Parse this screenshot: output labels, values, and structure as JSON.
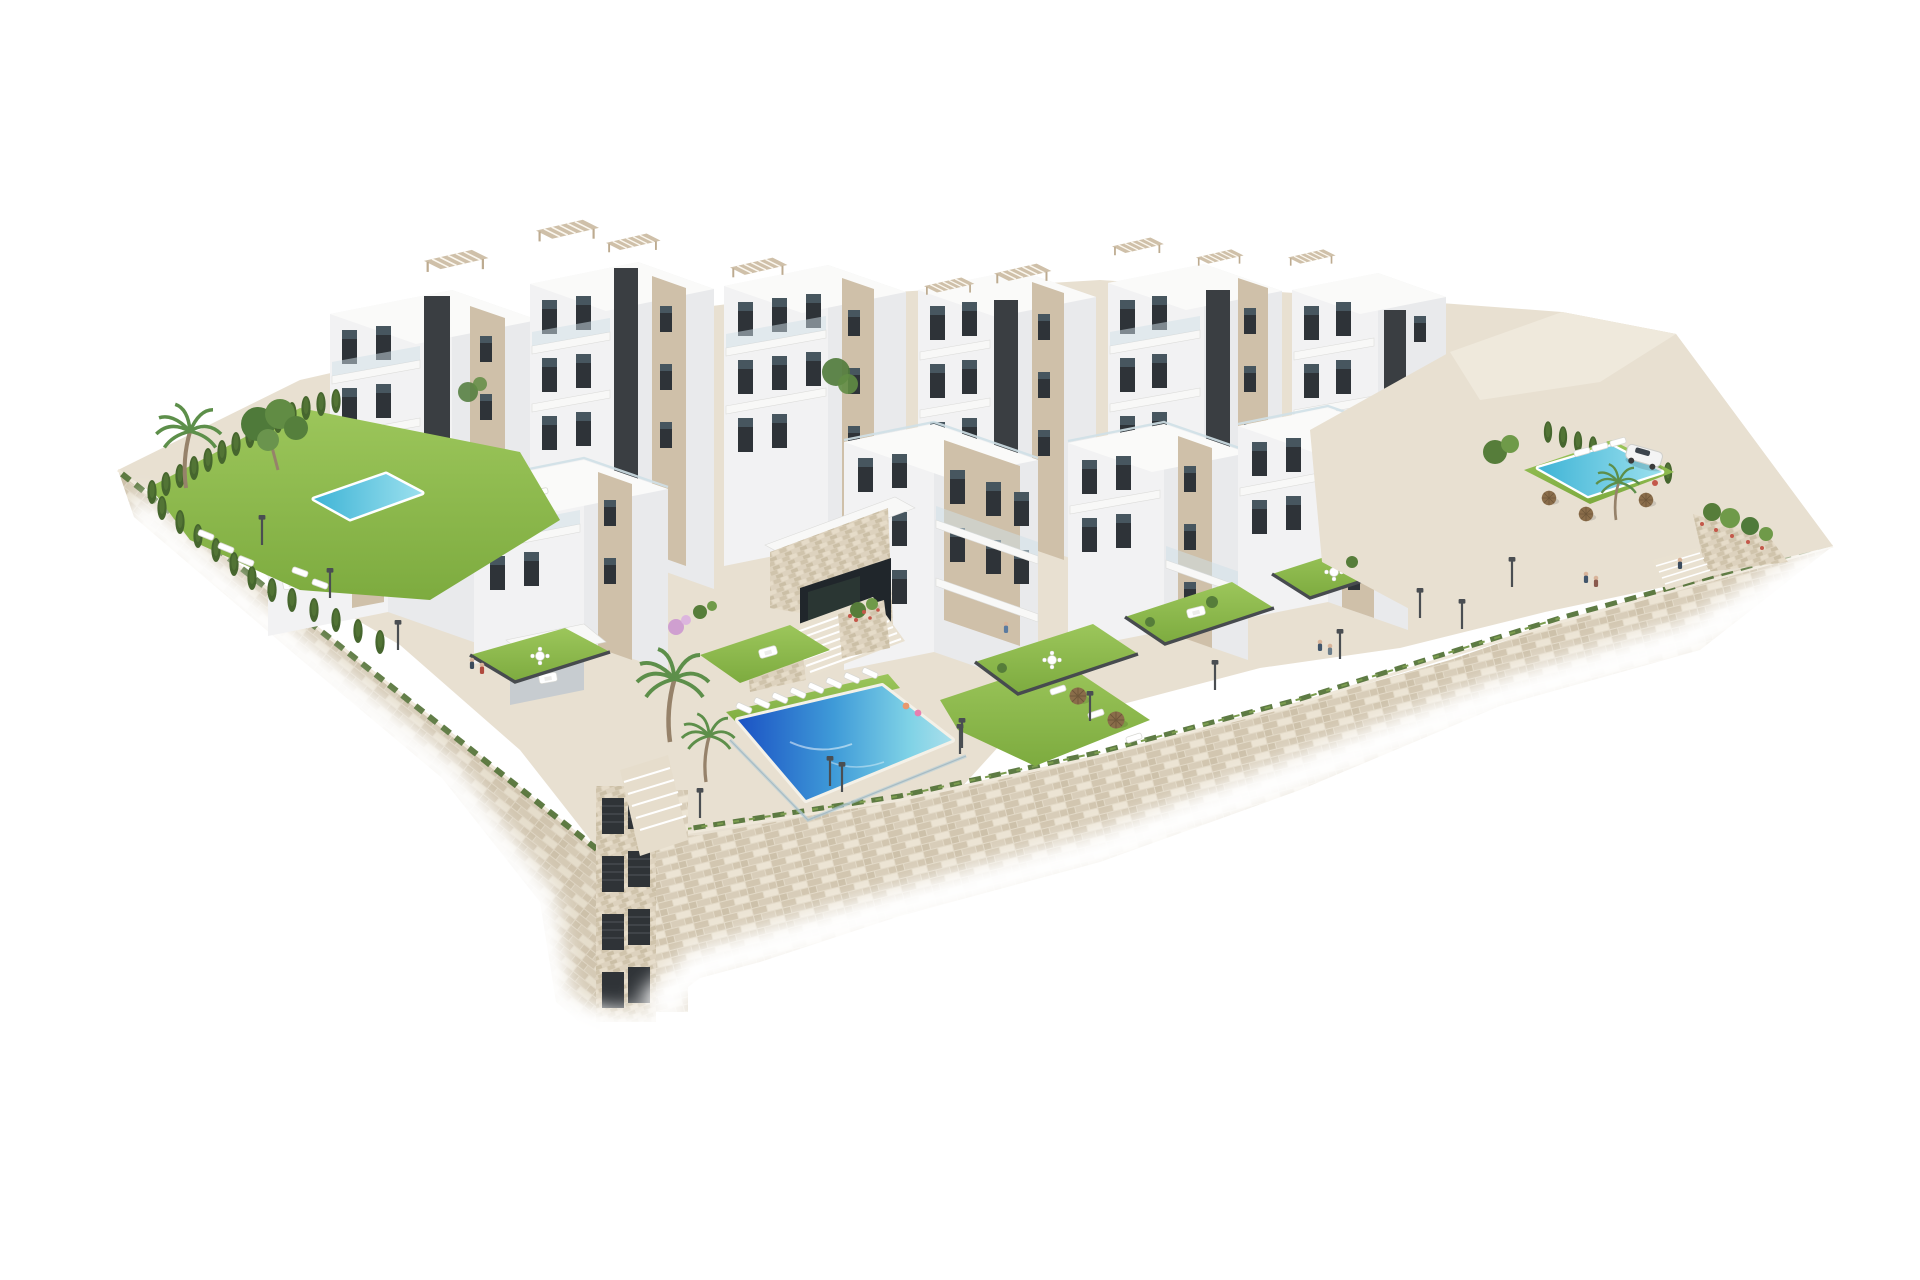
{
  "meta": {
    "type": "architectural-3d-render",
    "description": "Aerial 3D rendering of a terraced white residential complex built over a beige stone retaining wall, isolated on a pure white background"
  },
  "palette": {
    "background": "#ffffff",
    "face-l": "#f2f2f3",
    "face-r": "#e9eaec",
    "roof": "#fafaf9",
    "terrace": "#ececea",
    "beige": "#cfc0a9",
    "beige-dark": "#bdab90",
    "window": "#2e3338",
    "window-glass": "#5d7280",
    "core": "#3a3e42",
    "glass-rail": "#cfe0e7",
    "lawn": "#8cba4c",
    "lawn-dark": "#6f9a3a",
    "hedge": "#46662e",
    "pool-deep": "#1b52c4",
    "pool-mid": "#3f9bd8",
    "pool-light": "#7fd2e6",
    "pool-pale": "#aadfeb",
    "stone-base": "#e3dac8",
    "stone-dark": "#d2c6b0",
    "stone-light": "#ece4d4",
    "paving": "#e8e0d1",
    "paving-light": "#efe9dc",
    "umbrella": "#8a6d4a",
    "trunk": "#96826a",
    "frond": "#5d8f4a",
    "accent-red": "#c4584a",
    "blossom": "#cf9fd0",
    "car-white": "#f4f4f4",
    "lamp": "#4a4e52"
  },
  "scene": {
    "labels": {
      "site": "hillside residential complex on stone retaining walls",
      "retaining_wall": "beige stone retaining wall with grass fringe",
      "walkway": "perimeter walkway with street lamps",
      "back_buildings": "white apartment blocks with rooftop pergolas (back row)",
      "mid_buildings": "stepped apartment blocks with roof terraces (front row)",
      "entrance": "stone-clad entrance pavilion with wide stairs",
      "main_pool": "communal swimming pool with sun loungers and wicker parasols",
      "left_garden": "private corner garden with pool, palm and cypress hedge",
      "left_pool": "private garden pool",
      "plaza": "upper paved terrace",
      "plaza_pool": "upper terrace pool with parasols",
      "car": "white SUV parked on upper terrace",
      "gardens": "private lawn terraces with outdoor furniture",
      "hedges": "cypress hedges",
      "palms": "palm trees",
      "pine": "pine tree",
      "people": "residents",
      "pergolas": "rooftop timber pergolas",
      "shaft": "stone service shaft with louvred vents",
      "planters": "stone planters with shrubs and red flowers"
    },
    "counts": {
      "buildings": 12,
      "pools": 3,
      "palm_trees": 5,
      "street_lamps": 12,
      "parasols": 8,
      "sun_loungers": 24,
      "people": 9,
      "cars": 1
    }
  }
}
